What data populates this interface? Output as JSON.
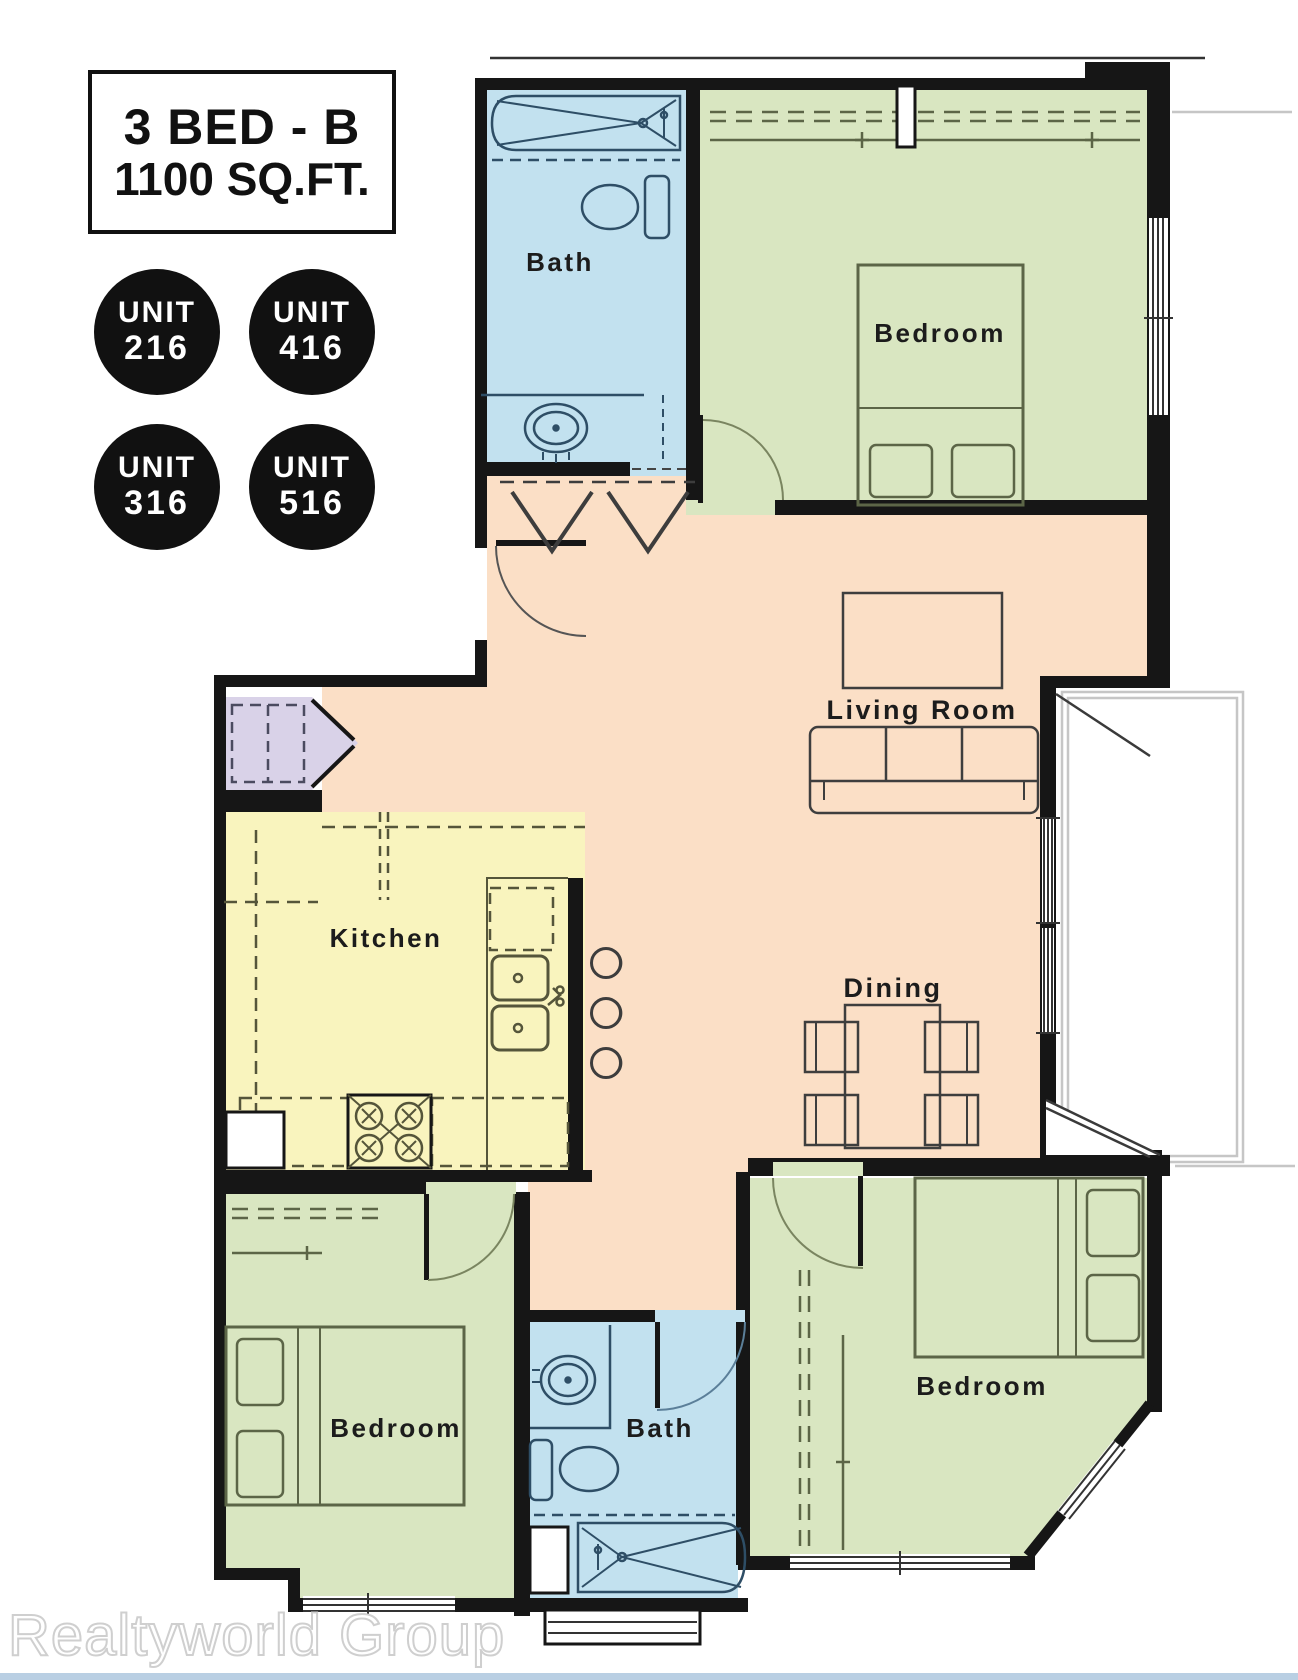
{
  "title_box": {
    "line1": "3 BED - B",
    "line2": "1100 SQ.FT."
  },
  "unit_badges": [
    {
      "label": "UNIT",
      "number": "216"
    },
    {
      "label": "UNIT",
      "number": "416"
    },
    {
      "label": "UNIT",
      "number": "316"
    },
    {
      "label": "UNIT",
      "number": "516"
    }
  ],
  "floor_plan": {
    "rooms": {
      "bath_top": {
        "label": "Bath"
      },
      "bedroom_top": {
        "label": "Bedroom"
      },
      "living_room": {
        "label": "Living Room"
      },
      "kitchen": {
        "label": "Kitchen"
      },
      "dining": {
        "label": "Dining"
      },
      "bedroom_left": {
        "label": "Bedroom"
      },
      "bath_bottom": {
        "label": "Bath"
      },
      "bedroom_right": {
        "label": "Bedroom"
      }
    },
    "colors": {
      "hall_living_dining": "#fbdfc6",
      "bedroom": "#d9e6c1",
      "bath": "#c2e1ef",
      "kitchen": "#f9f4be",
      "pantry": "#d9d2e8",
      "wall": "#161616",
      "context_gray": "#c6c6c6"
    }
  },
  "watermark": "Realtyworld Group",
  "footer_strip_color": "#b9cfe3",
  "badge_color": "#111111"
}
